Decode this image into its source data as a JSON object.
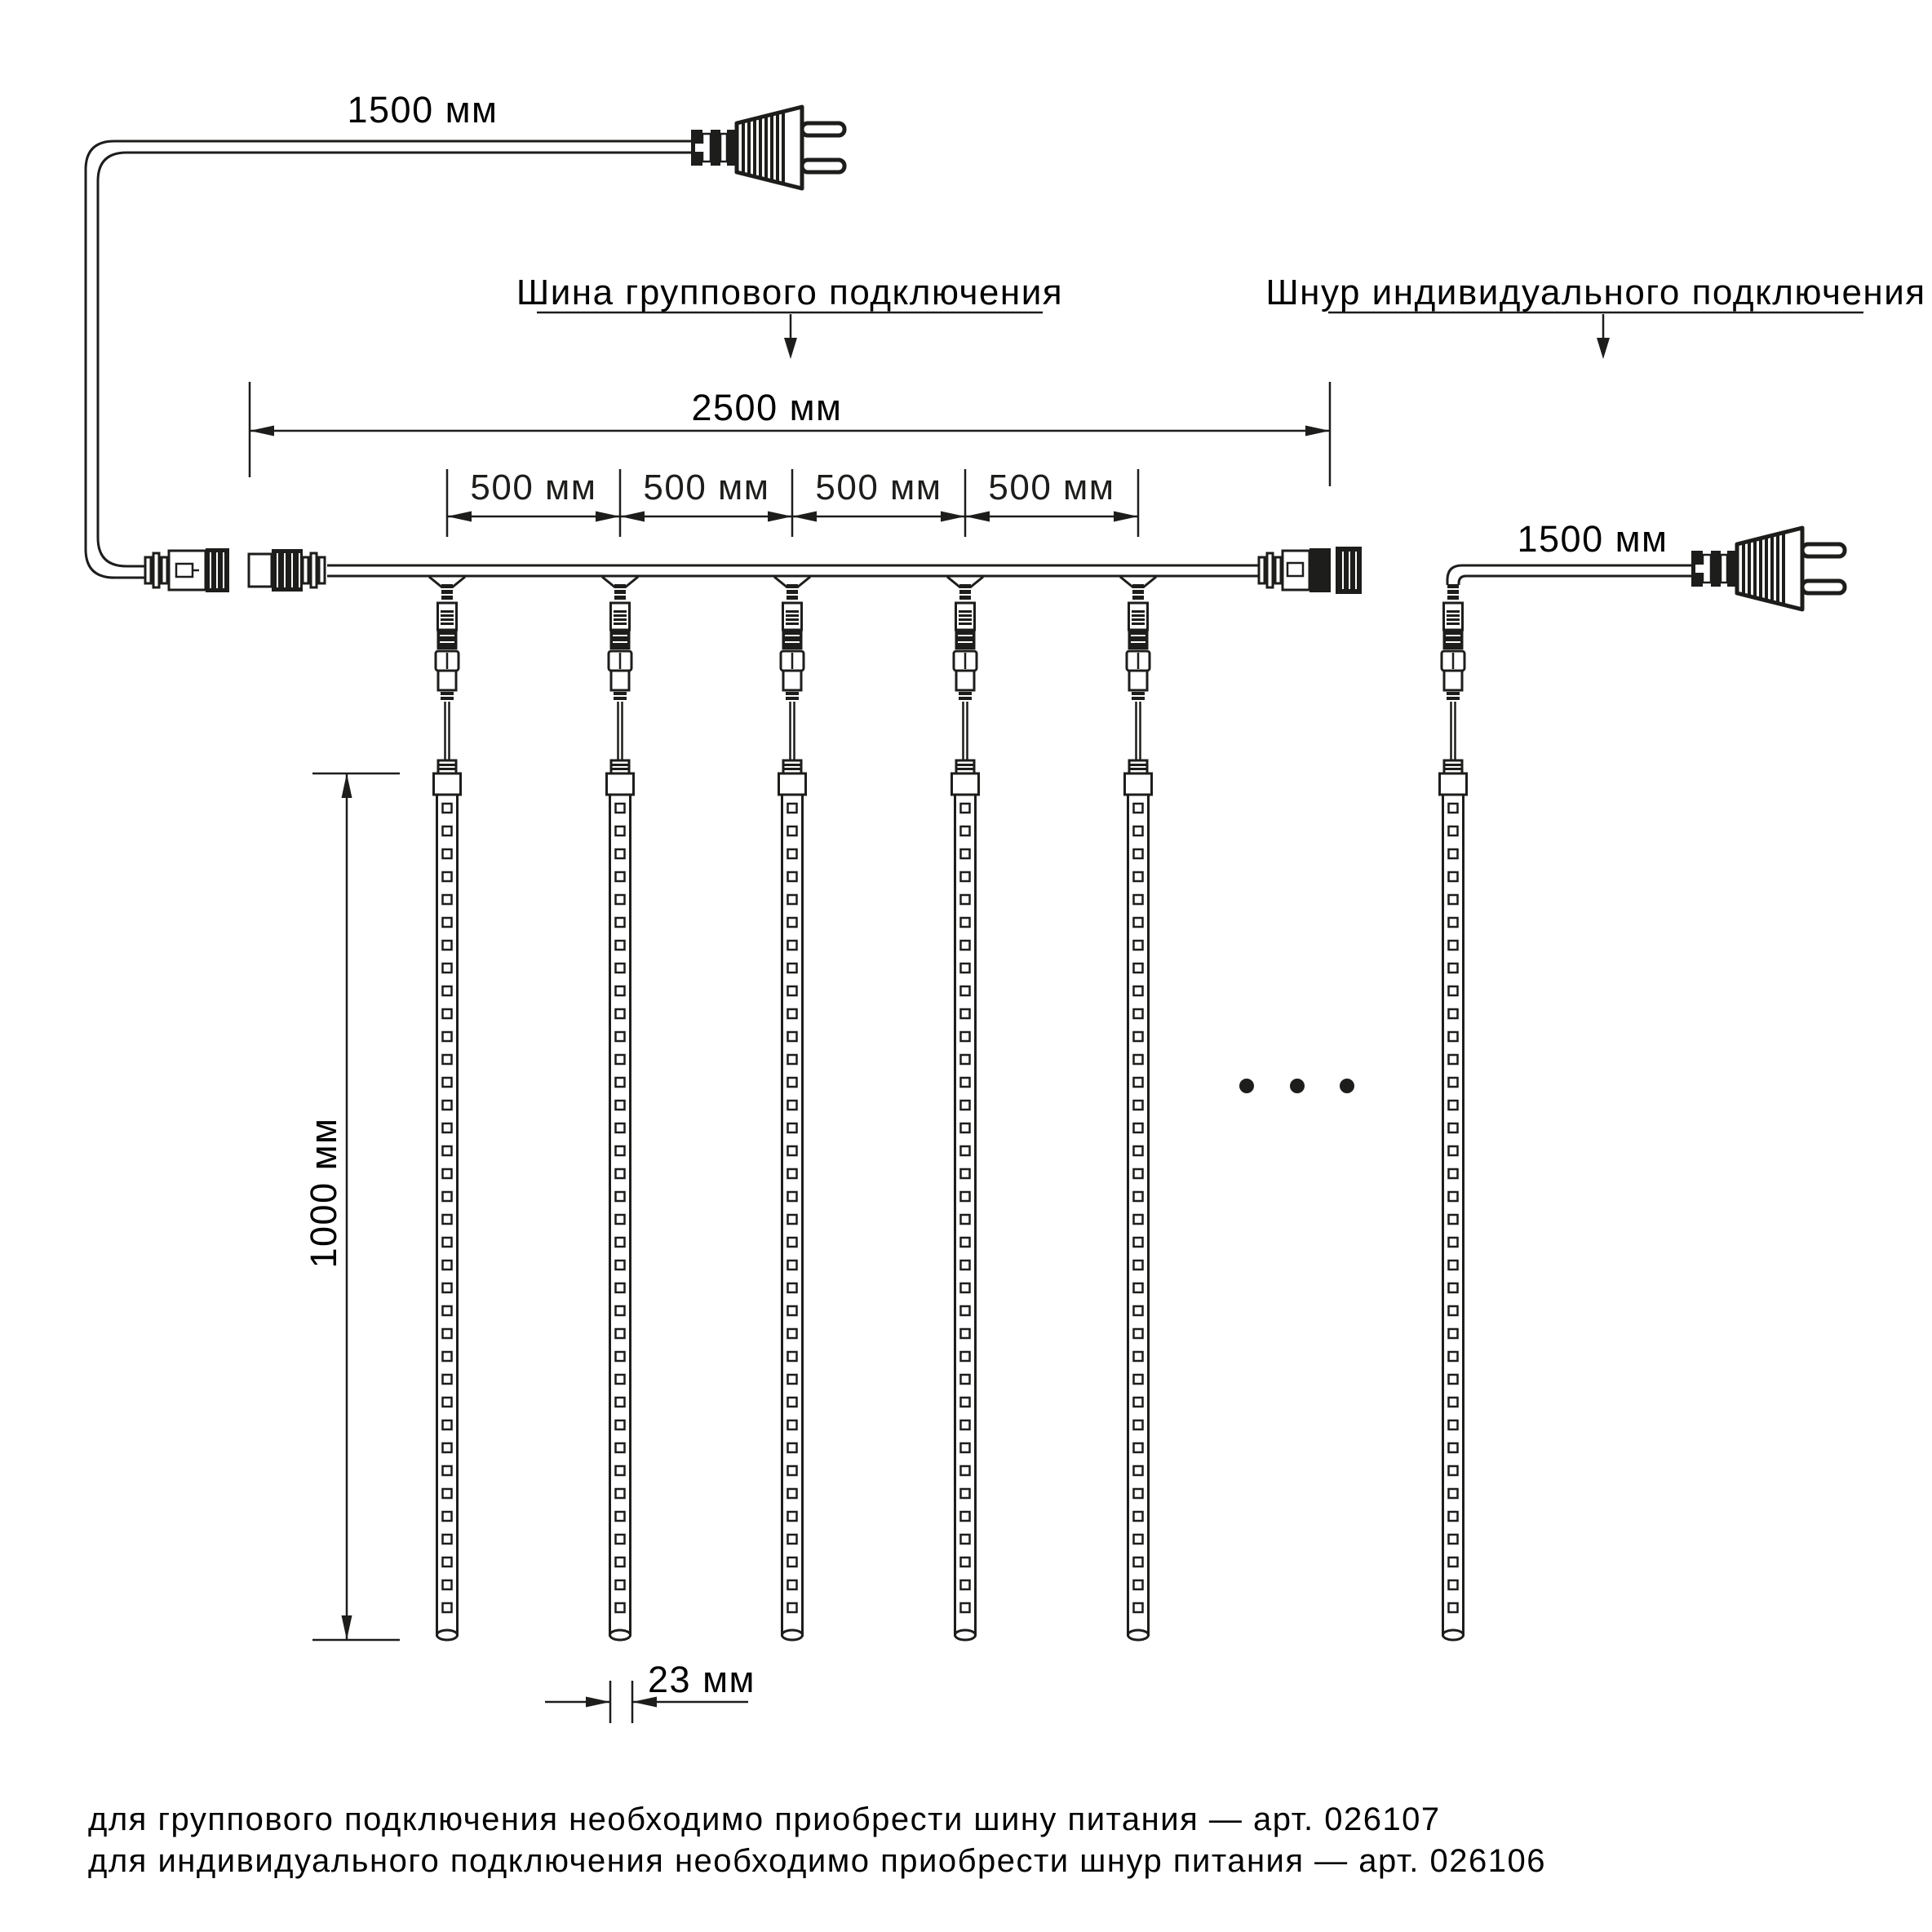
{
  "labels": {
    "plug_cord_length_top": "1500 мм",
    "plug_cord_length_right": "1500 мм",
    "group_bus_caption": "Шина группового подключения",
    "individual_cord_caption": "Шнур индивидуального подключения",
    "bus_total_length": "2500 мм",
    "segment_length": "500 мм",
    "tube_length": "1000 мм",
    "tube_width": "23 мм"
  },
  "footnotes": {
    "group": "для группового подключения необходимо приобрести шину питания — арт. 026107",
    "individual": "для индивидуального подключения необходимо приобрести шнур питания — арт. 026106"
  },
  "structure": {
    "group_tube_count": 5,
    "segment_count": 4,
    "led_count_per_tube": 36,
    "ellipsis_dot_count": 3
  },
  "colors": {
    "ink": "#1d1d1b",
    "background": "#ffffff"
  }
}
